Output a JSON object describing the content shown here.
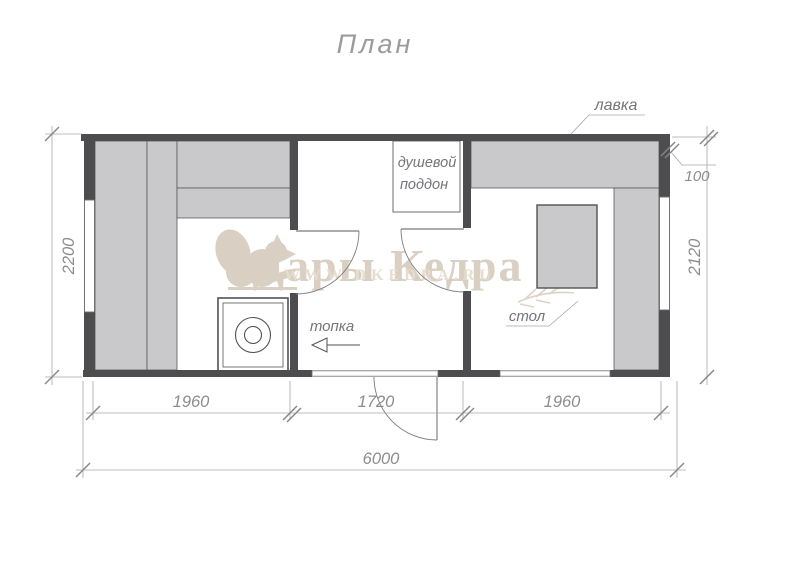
{
  "page": {
    "title": "План"
  },
  "watermark": {
    "brand": "Дары Кедра",
    "url": "WWW.DKEDRA.RU",
    "brand_color": "#d9cfc2",
    "url_color": "#e6ddcf"
  },
  "labels": {
    "bench": "лавка",
    "shower_line1": "душевой",
    "shower_line2": "поддон",
    "furnace": "топка",
    "table": "стол"
  },
  "dimensions": {
    "left_height": "2200",
    "right_height": "2120",
    "wall_offset": "100",
    "bottom_left": "1960",
    "bottom_middle": "1720",
    "bottom_right": "1960",
    "total_width": "6000"
  },
  "colors": {
    "wall": "#4d4d4f",
    "bench_fill": "#c9c9cb",
    "dim_line": "#a6a6a8",
    "label_text": "#74747a",
    "background": "#ffffff"
  }
}
